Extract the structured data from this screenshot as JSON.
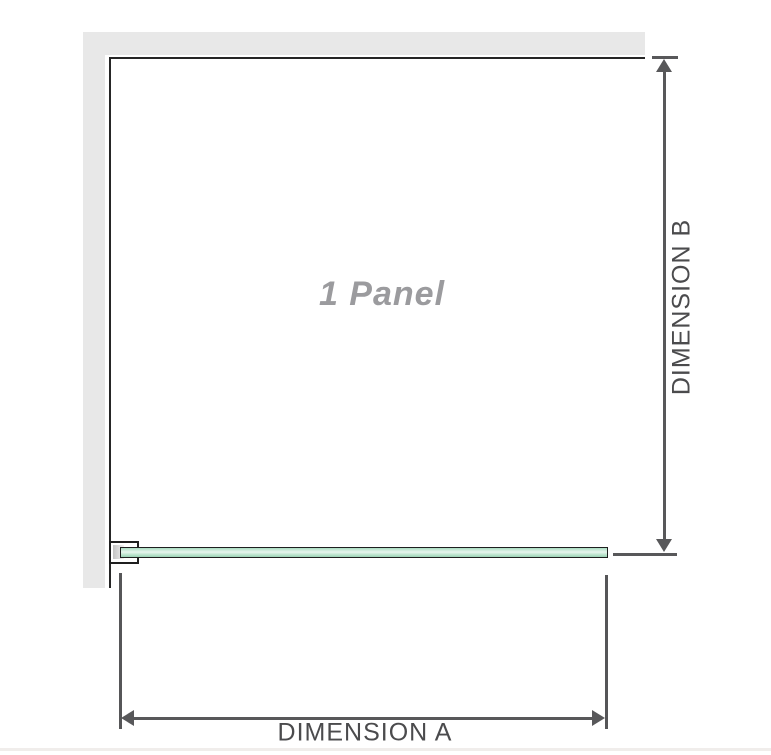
{
  "diagram": {
    "panel_label": "1 Panel",
    "dimension_a_label": "DIMENSION A",
    "dimension_b_label": "DIMENSION B",
    "colors": {
      "wall_gray": "#e8e8e8",
      "panel_outline": "#262626",
      "glass_green": "#a9dcc1",
      "glass_highlight": "#e8f6ee",
      "dimension_line": "#58585a",
      "panel_label_gray": "#9b9b9e",
      "dimension_text": "#4b4b4d",
      "page_divider": "#f0edeb"
    }
  }
}
